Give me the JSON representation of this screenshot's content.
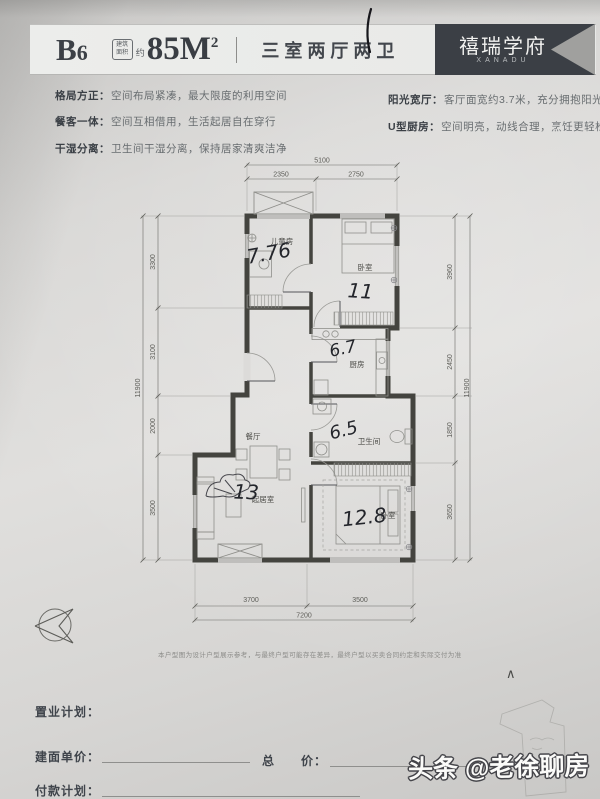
{
  "header": {
    "unit_letter": "B",
    "unit_num": "6",
    "seal_line1": "建筑",
    "seal_line2": "面积",
    "approx": "约",
    "area": "85M",
    "area_sup": "2",
    "layout": "三室两厅两卫",
    "brand": "禧瑞学府",
    "brand_en": "XANADU"
  },
  "features": [
    {
      "label": "格局方正：",
      "desc": "空间布局紧凑，最大限度的利用空间"
    },
    {
      "label": "餐客一体：",
      "desc": "空间互相借用，生活起居自在穿行"
    },
    {
      "label": "干湿分离：",
      "desc": "卫生间干湿分离，保持居家清爽洁净"
    },
    {
      "label": "阳光宽厅：",
      "desc": "客厅面宽约3.7米，充分拥抱阳光"
    },
    {
      "label": "U型厨房：",
      "desc": "空间明亮，动线合理，烹饪更轻松自在"
    }
  ],
  "floorplan": {
    "rooms": [
      {
        "name": "儿童房",
        "note": "7.76"
      },
      {
        "name": "卧室",
        "note": "11"
      },
      {
        "name": "厨房",
        "note": "6.7"
      },
      {
        "name": "卫生间",
        "note": "6.5"
      },
      {
        "name": "餐厅",
        "note": ""
      },
      {
        "name": "起居室",
        "note": "13"
      },
      {
        "name": "卧室",
        "note": "12.8"
      }
    ],
    "dims": {
      "top_total": "5100",
      "top_segs": [
        "2350",
        "2750"
      ],
      "left_total": "11900",
      "left_segs": [
        "3300",
        "3100",
        "2000",
        "3500"
      ],
      "right_total": "11900",
      "right_segs": [
        "3960",
        "2450",
        "1850",
        "3650"
      ],
      "bottom_total": "7200",
      "bottom_segs": [
        "3700",
        "3500"
      ]
    }
  },
  "disclaimer": "本户型图为设计户型展示参考，与最终户型可能存在差异，最终户型以买卖合同约定和实际交付为准",
  "form": {
    "plan_label": "置业计划：",
    "unit_price_label": "建面单价：",
    "total_price_label": "总　　价：",
    "payment_label": "付款计划："
  },
  "photo": {
    "watermark": "头条 @老徐聊房",
    "caret": "∧"
  }
}
